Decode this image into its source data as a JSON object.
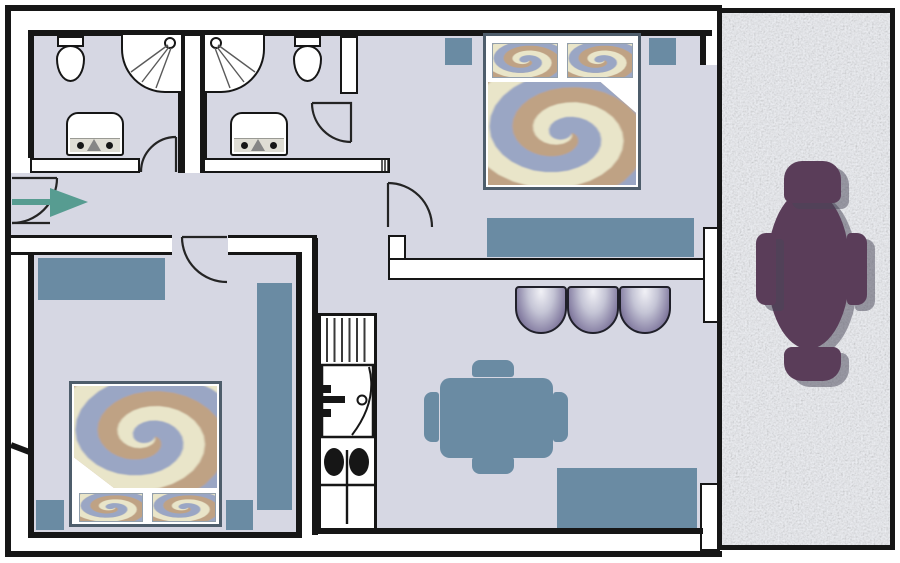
{
  "title": "apartment-floor-plan",
  "colors": {
    "wall": "#161616",
    "floor": "#d6d7e3",
    "blue": "#6a8ba3",
    "teal": "#579c91",
    "purple": "#5a3d59",
    "shadow": "rgba(72,70,88,0.5)",
    "balcony": "#eef0f5",
    "bedframe": "#4e5d6b",
    "pillowline": "#93a0ac",
    "sinkgray": "#dfddd4",
    "doorline": "#242424"
  },
  "swirl": {
    "colors": [
      "#bfa284",
      "#e9e5c9",
      "#9aa6c4"
    ],
    "turns": 1.85
  },
  "rooms": [
    {
      "name": "bathroom-1",
      "fixtures": [
        "toilet",
        "corner-shower",
        "washbasin"
      ]
    },
    {
      "name": "bathroom-2",
      "fixtures": [
        "corner-shower",
        "toilet",
        "washbasin"
      ]
    },
    {
      "name": "bedroom-top",
      "furniture": [
        "double-bed",
        "nightstand",
        "nightstand",
        "sideboard"
      ]
    },
    {
      "name": "bedroom-bottom",
      "furniture": [
        "double-bed",
        "nightstand",
        "nightstand",
        "dresser",
        "wardrobe"
      ]
    },
    {
      "name": "hallway",
      "furniture": [
        "entrance-arrow"
      ]
    },
    {
      "name": "kitchen",
      "fixtures": [
        "counter",
        "fridge",
        "cooktop",
        "sink"
      ]
    },
    {
      "name": "living-dining",
      "furniture": [
        "sofa-3-seats",
        "dining-table",
        "chair",
        "chair",
        "chair",
        "chair",
        "bench"
      ]
    },
    {
      "name": "balcony",
      "furniture": [
        "oval-table",
        "chair",
        "chair",
        "chair",
        "chair"
      ]
    }
  ],
  "doors": [
    "entrance-door",
    "bathroom-1-door",
    "bathroom-2-door",
    "bedroom-top-door",
    "bedroom-bottom-door"
  ]
}
